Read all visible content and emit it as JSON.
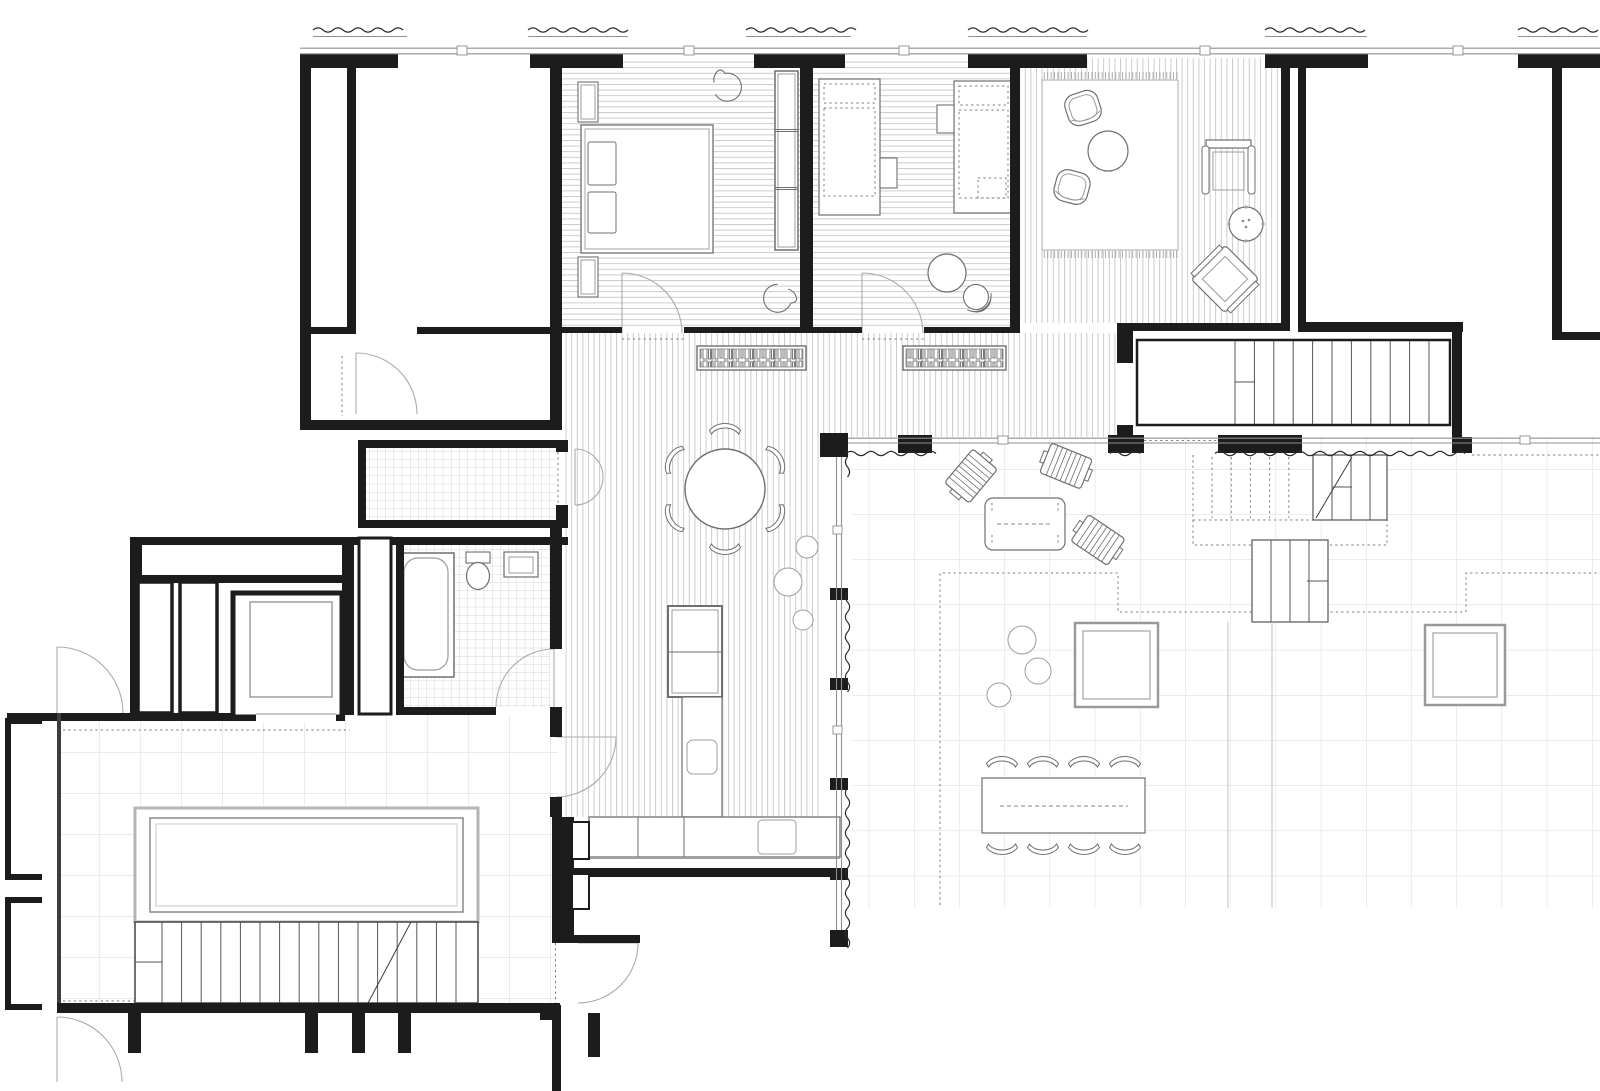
{
  "document": {
    "type": "architectural-floor-plan",
    "label": "Black-and-white residential apartment floor plan with two terraces, balcony, stairs and furniture symbols"
  },
  "canvas": {
    "width": 1600,
    "height": 1091,
    "background": "#ffffff"
  },
  "colors": {
    "wall": "#1c1c1c",
    "medium_line": "#3d3d3d",
    "furniture_line": "#6f6f6f",
    "light_line": "#9d9d9d",
    "door_arc": "#ababab",
    "dotted_line": "#7a7a7a",
    "window_line": "#8f8f8f",
    "wave_line": "#2a2a2a",
    "plank_hatch": "#c7c7c7",
    "small_tile": "#c3c8ca",
    "terrace_tile_left": "#d3d6d8",
    "terrace_tile_right": "#d5d8da",
    "fringe": "#9a9a9a",
    "stair_tread": "#555555"
  },
  "rooms": [
    {
      "id": "neighbor-room",
      "floor": "bare"
    },
    {
      "id": "bedroom",
      "floor": "wood-plank-horizontal"
    },
    {
      "id": "kids-room",
      "floor": "wood-plank-horizontal"
    },
    {
      "id": "lounge",
      "floor": "wood-plank-vertical"
    },
    {
      "id": "upper-right-room-a",
      "floor": "bare"
    },
    {
      "id": "upper-right-room-b",
      "floor": "bare"
    },
    {
      "id": "hallway-living",
      "floor": "wood-plank-vertical"
    },
    {
      "id": "wc",
      "floor": "small-tile"
    },
    {
      "id": "bathroom",
      "floor": "small-tile"
    },
    {
      "id": "kitchen",
      "floor": "wood-plank-vertical"
    },
    {
      "id": "elevator-lobby",
      "floor": "bare"
    },
    {
      "id": "balcony",
      "floor": "bare-with-stairs"
    },
    {
      "id": "terrace-left",
      "floor": "large-tile"
    },
    {
      "id": "terrace-right",
      "floor": "large-tile"
    }
  ],
  "furniture": [
    "double-bed",
    "pillow",
    "wardrobe",
    "swivel-chair",
    "radiator-box",
    "single-bed",
    "desk-table",
    "round-side-table",
    "office-chair",
    "rug-with-fringe",
    "organic-armchair",
    "round-coffee-table",
    "folding-chair",
    "frame-lounge-chair",
    "dot-side-table",
    "round-dining-table",
    "dining-chair",
    "bookshelf",
    "kitchen-island",
    "kitchen-counter",
    "sink",
    "cooktop",
    "bathtub",
    "toilet",
    "washbasin",
    "elevator-car",
    "duct-closet",
    "outdoor-dining-table",
    "outdoor-dining-chair",
    "sun-lounger",
    "outdoor-coffee-table",
    "plant-pot",
    "planter-bed",
    "skylight",
    "staircase",
    "door-swing",
    "window",
    "awning-wave-line"
  ]
}
